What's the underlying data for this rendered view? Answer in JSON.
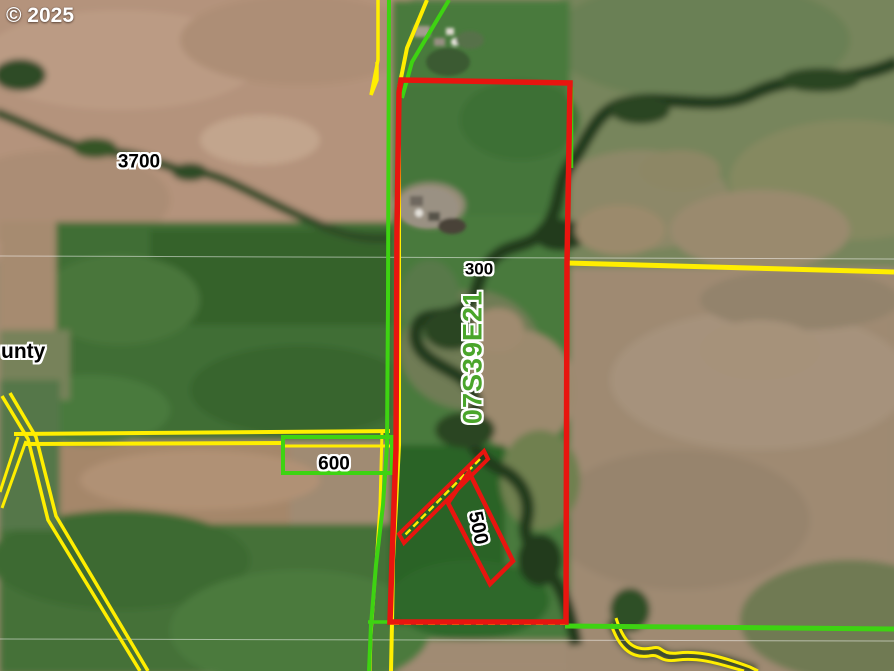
{
  "map": {
    "copyright": "© 2025",
    "labels": {
      "taxlot_3700": "3700",
      "taxlot_300": "300",
      "taxlot_600": "600",
      "taxlot_500": "500",
      "township_section": "07S39E21",
      "county_partial": "unty"
    },
    "colors": {
      "parcel_highlight_red": "#e8150f",
      "taxlot_line_yellow": "#ffee00",
      "boundary_line_green": "#3ed312",
      "township_text_green": "#4aa52b",
      "label_text_black": "#000000",
      "label_halo_white": "#ffffff",
      "copyright_text": "#ffffff",
      "section_line_white": "#ffffff"
    }
  }
}
